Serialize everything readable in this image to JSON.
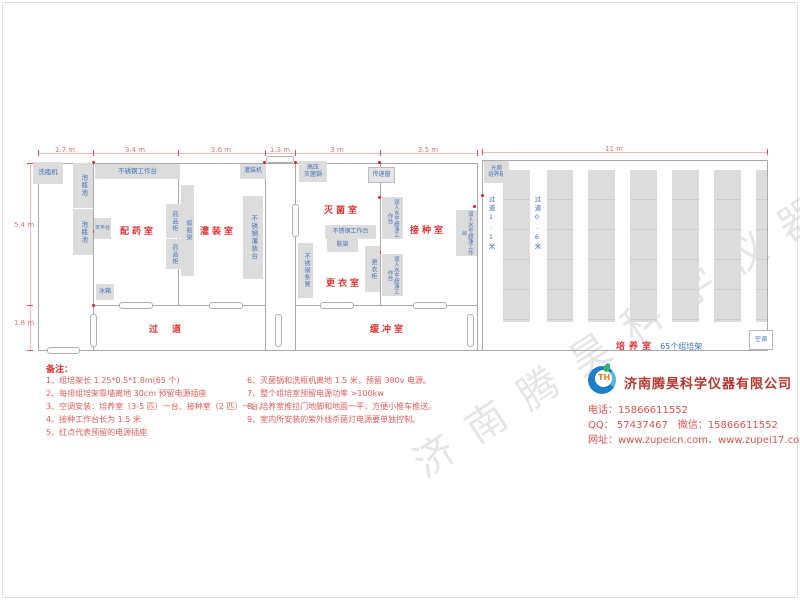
{
  "watermark": "济南腾昊科学仪器有限公司",
  "dims": {
    "w17": "1.7 m",
    "w34": "3.4 m",
    "w36": "3.6 m",
    "w13": "1.3 m",
    "w3": "3 m",
    "w35": "3.5 m",
    "w11": "11 m",
    "h54": "5.4 m",
    "h18": "1.8 m"
  },
  "rooms": {
    "dispensing": "配药室",
    "filling": "灌装室",
    "sterilizing": "灭菌室",
    "changing": "更衣室",
    "inoculation": "接种室",
    "corridor": "过道",
    "buffer": "缓冲室",
    "culture": "培养室",
    "culture_sub": "65个组培架"
  },
  "equipment": {
    "washer": "洗瓶机",
    "soak_pool": "泡瓶池",
    "ss_workbench": "不锈钢工作台",
    "balance_table": "天平台",
    "medicine_cabinet": "药品柜",
    "bottle_rack": "晾瓶架",
    "fridge": "冰箱",
    "filling_machine": "灌装机",
    "ss_filling_table": "不锈钢灌装台",
    "autoclave_l1": "高压",
    "autoclave_l2": "灭菌锅",
    "pass_window": "传递窗",
    "shoe_rack": "鞋架",
    "ss_bench": "不锈钢条凳",
    "locker": "更衣柜",
    "clean_bench": "双人水平超净工作台",
    "incubator_l1": "光照",
    "incubator_l2": "培养箱",
    "air_conditioner": "空调",
    "aisle_wide": "过道1.1米",
    "aisle_narrow": "过道0.6米"
  },
  "notes": {
    "title": "备注：",
    "col1": [
      "1、组培架长 1.25*0.5*1.8m(65 个)",
      "2、每排组培架靠墙离地 30cm 预留电源插座",
      "3、空调安装：培养室（3-5 匹）一台、接种室（2 匹）一台。",
      "4、接种工作台长为 1.5 米",
      "5、红点代表预留的电源插座"
    ],
    "col2": [
      "6、灭菌锅和洗瓶机离地 1.5 米，预留 380v 电源。",
      "7、整个组培室预留电源功率 >100kw",
      "8、培养室推拉门地脚和地面一平，方便小推车推送。",
      "9、室内所安装的紫外线杀菌灯电源要单独控制。"
    ]
  },
  "company": {
    "name": "济南腾昊科学仪器有限公司",
    "line1": "电话：15866611552",
    "line2": "QQ： 57437467　微信：15866611552",
    "line3": "网址：www.zupeicn.com、www.zupei17.com"
  }
}
